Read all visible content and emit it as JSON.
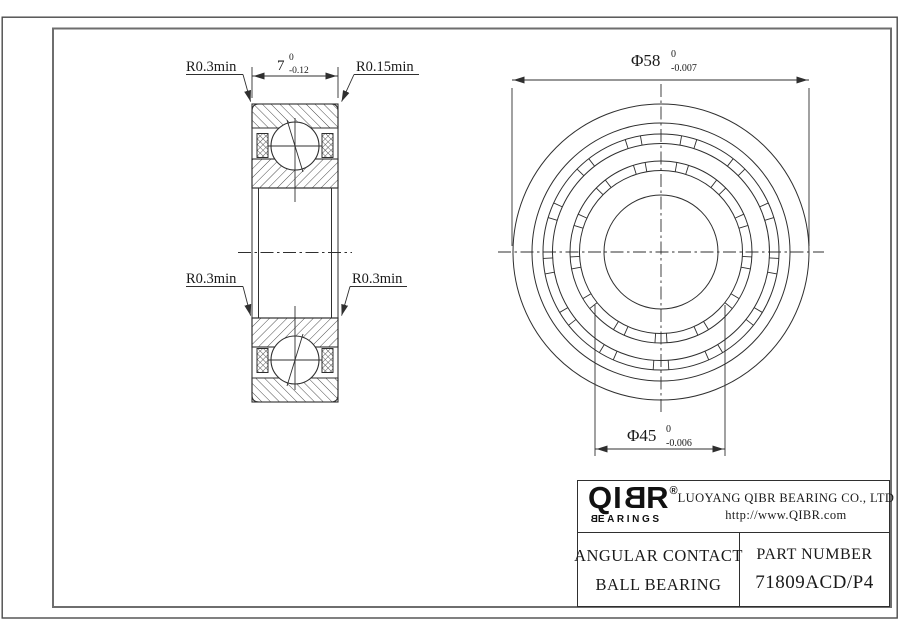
{
  "left_view": {
    "label_top_left": "R0.3min",
    "label_top_right": "R0.15min",
    "label_mid_left": "R0.3min",
    "label_mid_right": "R0.3min",
    "dim_width": {
      "value": "7",
      "tol_upper": "0",
      "tol_lower": "-0.12"
    }
  },
  "right_view": {
    "dim_outer": {
      "value": "Φ58",
      "tol_upper": "0",
      "tol_lower": "-0.007"
    },
    "dim_bore": {
      "value": "Φ45",
      "tol_upper": "0",
      "tol_lower": "-0.006"
    }
  },
  "title_block": {
    "logo_text": "QIBR",
    "logo_registered": "®",
    "logo_subtext": "BEARINGS",
    "company": "LUOYANG QIBR BEARING CO., LTD",
    "website": "http://www.QIBR.com",
    "product_name_line1": "ANGULAR CONTACT",
    "product_name_line2": "BALL BEARING",
    "part_number_label": "PART NUMBER",
    "part_number": "71809ACD/P4"
  },
  "colors": {
    "line": "#2f2f2f",
    "text": "#1a1a1a"
  }
}
